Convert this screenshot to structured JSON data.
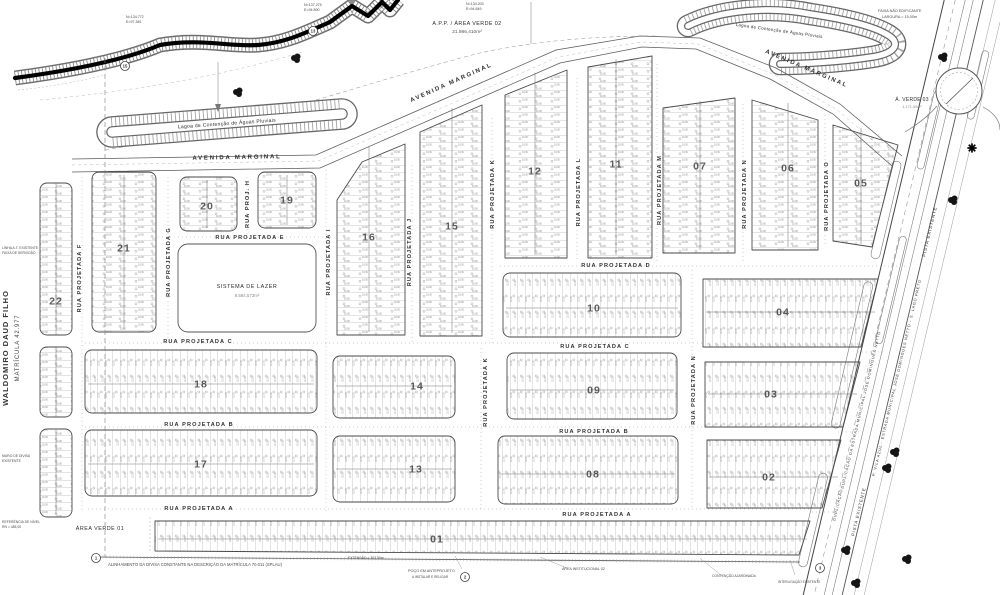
{
  "map": {
    "lot_dim": "10,00",
    "owner": {
      "name": "WALDOMIRO DAUD FILHO",
      "registry": "MATRÍCULA 42.977"
    },
    "ponds": [
      {
        "label": "Lagoa de Contenção de Águas Pluviais"
      },
      {
        "label": "Lagoa de Contenção de Águas Pluviais"
      }
    ],
    "areas": {
      "app": {
        "label": "A.P.P. / ÁREA VERDE 02",
        "value": "21.986,410m²"
      },
      "verde01": {
        "label": "ÁREA VERDE 01"
      },
      "verde03": {
        "label": "Á. VERDE 03",
        "value": "1.171,50m²"
      },
      "lazer": {
        "label": "SISTEMA DE LAZER",
        "value": "8.584,573m²"
      }
    },
    "avenues": [
      {
        "label": "AVENIDA MARGINAL",
        "x": 237,
        "y": 159,
        "rot": -1
      },
      {
        "label": "AVENIDA MARGINAL",
        "x": 452,
        "y": 84,
        "rot": -24
      },
      {
        "label": "AVENIDA MARGINAL",
        "x": 806,
        "y": 70,
        "rot": 23
      }
    ],
    "streets_h": [
      {
        "label": "RUA PROJETADA  E",
        "x": 250,
        "y": 239
      },
      {
        "label": "RUA PROJETADA  D",
        "x": 616,
        "y": 267
      },
      {
        "label": "RUA PROJETADA  C",
        "x": 198,
        "y": 343
      },
      {
        "label": "RUA PROJETADA  C",
        "x": 595,
        "y": 348
      },
      {
        "label": "RUA PROJETADA  B",
        "x": 199,
        "y": 426
      },
      {
        "label": "RUA PROJETADA  B",
        "x": 594,
        "y": 433
      },
      {
        "label": "RUA PROJETADA  A",
        "x": 199,
        "y": 510
      },
      {
        "label": "RUA PROJETADA  A",
        "x": 597,
        "y": 516
      }
    ],
    "streets_v": [
      {
        "label": "RUA PROJETADA F",
        "x": 81,
        "y": 278
      },
      {
        "label": "RUA PROJETADA G",
        "x": 170,
        "y": 262
      },
      {
        "label": "RUA PROJ. H",
        "x": 249,
        "y": 204
      },
      {
        "label": "RUA PROJETADA I",
        "x": 330,
        "y": 262
      },
      {
        "label": "RUA PROJETADA J",
        "x": 411,
        "y": 252
      },
      {
        "label": "RUA PROJETADA K",
        "x": 494,
        "y": 194
      },
      {
        "label": "RUA PROJETADA K",
        "x": 487,
        "y": 392
      },
      {
        "label": "RUA PROJETADA L",
        "x": 580,
        "y": 192
      },
      {
        "label": "RUA PROJETADA M",
        "x": 661,
        "y": 190
      },
      {
        "label": "RUA PROJETADA N",
        "x": 746,
        "y": 194
      },
      {
        "label": "RUA PROJETADA O",
        "x": 828,
        "y": 196
      },
      {
        "label": "RUA PROJETADA N",
        "x": 695,
        "y": 390
      }
    ],
    "corridor_labels": [
      {
        "t": "PISTA EXISTENTE",
        "x": 931,
        "y": 232,
        "s": 4.6
      },
      {
        "t": "PISTA EXISTENTE",
        "x": 860,
        "y": 512,
        "s": 4.4
      },
      {
        "t": "DUPLICAÇÃO DA ESTRADA MUNICIPAL JOSÉ DOMINGUES NETTO",
        "x": 862,
        "y": 410,
        "s": 3.8
      },
      {
        "t": "P. VILA AZUL - ESTRADA MUNICIPAL JOSÉ DOMINGUES NETTO - S. LAGO PRETO",
        "x": 898,
        "y": 378,
        "s": 3.8
      },
      {
        "t": "DUPLICAÇÃO",
        "x": 839,
        "y": 505,
        "s": 3.8
      }
    ],
    "blocks": [
      {
        "num": "22",
        "rect": [
          40,
          183,
          32,
          152
        ],
        "dir": "h",
        "nxy": [
          56,
          301
        ]
      },
      {
        "num": "",
        "rect": [
          40,
          347,
          32,
          70
        ],
        "dir": "h"
      },
      {
        "num": "",
        "rect": [
          40,
          429,
          32,
          88
        ],
        "dir": "h"
      },
      {
        "num": "21",
        "rect": [
          92,
          172,
          64,
          160
        ],
        "dir": "h",
        "nxy": [
          124,
          248
        ]
      },
      {
        "num": "20",
        "rect": [
          180,
          177,
          57,
          54
        ],
        "dir": "h",
        "nxy": [
          207,
          206
        ]
      },
      {
        "num": "19",
        "rect": [
          258,
          172,
          58,
          56
        ],
        "dir": "h",
        "nxy": [
          287,
          200
        ]
      },
      {
        "num": "16",
        "pts": [
          [
            337,
            200
          ],
          [
            362,
            162
          ],
          [
            405,
            144
          ],
          [
            405,
            335
          ],
          [
            337,
            335
          ]
        ],
        "dir": "h",
        "nxy": [
          369,
          237
        ]
      },
      {
        "num": "15",
        "pts": [
          [
            420,
            132
          ],
          [
            482,
            105
          ],
          [
            482,
            336
          ],
          [
            420,
            336
          ]
        ],
        "dir": "h",
        "nxy": [
          452,
          226
        ]
      },
      {
        "num": "12",
        "pts": [
          [
            505,
            95
          ],
          [
            567,
            70
          ],
          [
            567,
            258
          ],
          [
            505,
            258
          ]
        ],
        "dir": "h",
        "nxy": [
          535,
          171
        ]
      },
      {
        "num": "11",
        "pts": [
          [
            588,
            67
          ],
          [
            652,
            56
          ],
          [
            652,
            258
          ],
          [
            588,
            258
          ]
        ],
        "dir": "h",
        "nxy": [
          616,
          164
        ]
      },
      {
        "num": "07",
        "pts": [
          [
            663,
            108
          ],
          [
            735,
            98
          ],
          [
            735,
            253
          ],
          [
            663,
            253
          ]
        ],
        "dir": "h",
        "nxy": [
          700,
          166
        ]
      },
      {
        "num": "06",
        "pts": [
          [
            752,
            100
          ],
          [
            818,
            120
          ],
          [
            818,
            250
          ],
          [
            752,
            250
          ]
        ],
        "dir": "h",
        "nxy": [
          788,
          168
        ]
      },
      {
        "num": "05",
        "pts": [
          [
            833,
            125
          ],
          [
            898,
            145
          ],
          [
            872,
            247
          ],
          [
            833,
            241
          ]
        ],
        "dir": "h",
        "nxy": [
          861,
          183
        ]
      },
      {
        "num": "10",
        "rect": [
          503,
          273,
          178,
          64
        ],
        "dir": "v",
        "nxy": [
          594,
          308
        ]
      },
      {
        "num": "04",
        "pts": [
          [
            703,
            279
          ],
          [
            878,
            279
          ],
          [
            861,
            347
          ],
          [
            703,
            347
          ]
        ],
        "dir": "v",
        "nxy": [
          783,
          312
        ]
      },
      {
        "num": "18",
        "rect": [
          85,
          350,
          232,
          63
        ],
        "dir": "v",
        "nxy": [
          201,
          384
        ]
      },
      {
        "num": "14",
        "rect": [
          333,
          356,
          122,
          62
        ],
        "dir": "v",
        "nxy": [
          417,
          386
        ]
      },
      {
        "num": "09",
        "rect": [
          507,
          353,
          170,
          66
        ],
        "dir": "v",
        "nxy": [
          594,
          390
        ]
      },
      {
        "num": "03",
        "pts": [
          [
            705,
            362
          ],
          [
            860,
            362
          ],
          [
            843,
            427
          ],
          [
            705,
            427
          ]
        ],
        "dir": "v",
        "nxy": [
          771,
          394
        ]
      },
      {
        "num": "17",
        "rect": [
          85,
          430,
          232,
          66
        ],
        "dir": "v",
        "nxy": [
          201,
          464
        ]
      },
      {
        "num": "13",
        "rect": [
          333,
          436,
          122,
          66
        ],
        "dir": "v",
        "nxy": [
          416,
          469
        ]
      },
      {
        "num": "08",
        "rect": [
          498,
          436,
          180,
          68
        ],
        "dir": "v",
        "nxy": [
          593,
          474
        ]
      },
      {
        "num": "02",
        "pts": [
          [
            707,
            440
          ],
          [
            841,
            440
          ],
          [
            822,
            508
          ],
          [
            707,
            508
          ]
        ],
        "dir": "v",
        "nxy": [
          769,
          477
        ]
      },
      {
        "num": "01",
        "pts": [
          [
            155,
            521
          ],
          [
            810,
            521
          ],
          [
            799,
            555
          ],
          [
            155,
            551
          ]
        ],
        "dir": "v",
        "nxy": [
          437,
          539
        ]
      }
    ],
    "markers": [
      {
        "n": "15",
        "x": 125,
        "y": 66
      },
      {
        "n": "13",
        "x": 313,
        "y": 31
      },
      {
        "n": "1",
        "x": 96,
        "y": 558
      },
      {
        "n": "2",
        "x": 465,
        "y": 577
      },
      {
        "n": "3",
        "x": 820,
        "y": 568
      }
    ],
    "notes": [
      {
        "t": "N=134.772",
        "x": 126,
        "y": 18,
        "s": 3.6,
        "a": "start"
      },
      {
        "t": "E=97.381",
        "x": 126,
        "y": 23,
        "s": 3.6,
        "a": "start"
      },
      {
        "t": "N=137.275",
        "x": 304,
        "y": 6,
        "s": 3.6,
        "a": "start"
      },
      {
        "t": "E=94.890",
        "x": 304,
        "y": 11,
        "s": 3.6,
        "a": "start"
      },
      {
        "t": "N=134.203",
        "x": 466,
        "y": 5,
        "s": 3.6,
        "a": "start"
      },
      {
        "t": "E=94.849",
        "x": 466,
        "y": 10,
        "s": 3.6,
        "a": "start"
      },
      {
        "t": "FAIXA NÃO EDIFICANTE",
        "x": 878,
        "y": 12,
        "s": 3.8,
        "a": "start"
      },
      {
        "t": "LARGURA = 15,00m",
        "x": 882,
        "y": 18,
        "s": 3.8,
        "a": "start"
      },
      {
        "t": "LINHA A.T. EXISTENTE",
        "x": 2,
        "y": 249,
        "s": 3.4,
        "a": "start"
      },
      {
        "t": "FAIXA DE SERVIDÃO",
        "x": 2,
        "y": 254,
        "s": 3.4,
        "a": "start"
      },
      {
        "t": "MURO DE DIVISA",
        "x": 2,
        "y": 457,
        "s": 3.4,
        "a": "start"
      },
      {
        "t": "EXISTENTE",
        "x": 2,
        "y": 462,
        "s": 3.4,
        "a": "start"
      },
      {
        "t": "REFERÊNCIA DE NÍVEL",
        "x": 2,
        "y": 523,
        "s": 3.4,
        "a": "start"
      },
      {
        "t": "RN = 485,00",
        "x": 2,
        "y": 528,
        "s": 3.4,
        "a": "start"
      },
      {
        "t": "ALINHAMENTO DA DIVISA CONSTANTE NA DESCRIÇÃO DA MATRÍCULA 70.011 (SPLAU)",
        "x": 108,
        "y": 566,
        "s": 4.2,
        "a": "start"
      },
      {
        "t": "EXTENSÃO = 303,50m",
        "x": 348,
        "y": 559,
        "s": 3.4,
        "a": "start"
      },
      {
        "t": "POÇO EM ANTEPROJETO",
        "x": 408,
        "y": 572,
        "s": 3.8,
        "a": "start"
      },
      {
        "t": "A INSTALAR E RELIGAR",
        "x": 412,
        "y": 578,
        "s": 3.2,
        "a": "start"
      },
      {
        "t": "ÁREA INSTITUCIONAL 02",
        "x": 562,
        "y": 570,
        "s": 3.6,
        "a": "start"
      },
      {
        "t": "CONTENÇÃO AJARDINADA",
        "x": 712,
        "y": 577,
        "s": 3.4,
        "a": "start"
      },
      {
        "t": "INTERLIGAÇÃO EXISTENTE",
        "x": 778,
        "y": 583,
        "s": 3.2,
        "a": "start"
      }
    ]
  }
}
